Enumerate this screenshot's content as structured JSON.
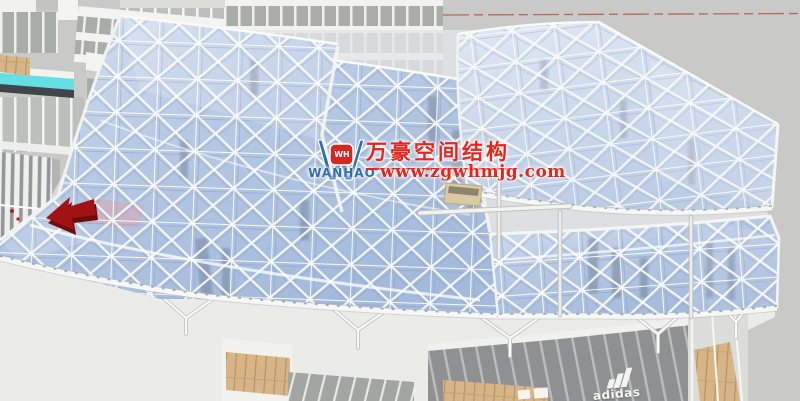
{
  "watermark": {
    "logo_monogram": "WH",
    "logo_name": "WANHAO",
    "company_name_cn": "万豪空间结构",
    "website": "www.zgwhmjg.com",
    "text_color": "#E8251C",
    "logo_blue": "#2F6CB5",
    "logo_red": "#D52721"
  },
  "signage": {
    "storefront_label": "adidas"
  },
  "scene": {
    "sky_color": "#C9C9C7",
    "canopy_glass_color": "#B5C8E4",
    "canopy_frame_color": "#FDFDFC",
    "axis_line_color": "#BC5A52",
    "arrow_marker_color": "#A31212",
    "water_channel_color": "#62E0E3",
    "wood_deck_color": "#D7B587",
    "grass_strip_color": "#7FAE3F"
  }
}
